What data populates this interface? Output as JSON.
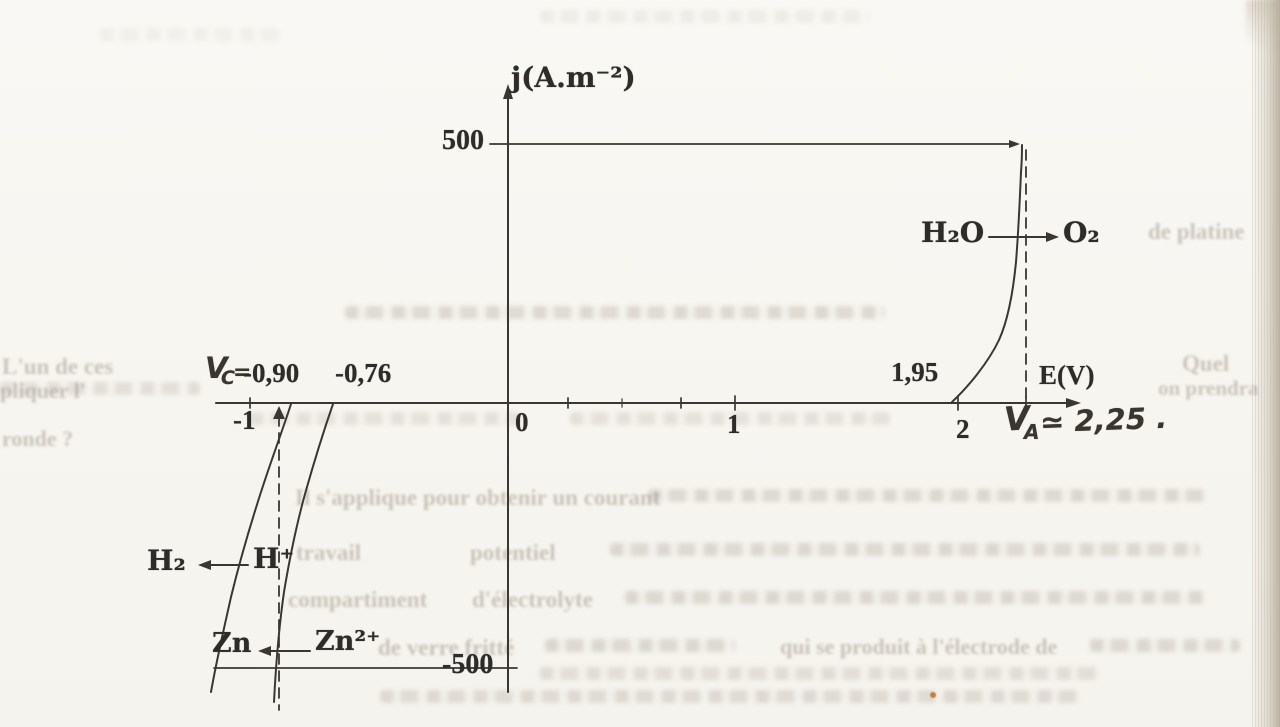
{
  "paper": {
    "background_color": "#f7f5f0",
    "ink_color": "#3a3733",
    "bleed_text_color": "#a49d8d",
    "accent_dot_color": "#c0803d"
  },
  "labels": {
    "y_axis": "j(A.m⁻²)",
    "y_max": "500",
    "y_min": "-500",
    "x_axis": "E(V)",
    "tick_minus1": "-1",
    "tick_0": "0",
    "tick_1": "1",
    "tick_2": "2",
    "anode_onset": "1,95",
    "vc_v": "V",
    "vc_sub": "C",
    "vc_eq": "=",
    "vc_value1": "-0,90",
    "vc_value2": "-0,76",
    "va_v": "V",
    "va_sub": "A",
    "va_value": "≃ 2,25 .",
    "h2o": "H₂O",
    "o2": "O₂",
    "h2": "H₂",
    "hplus": "H⁺",
    "zn": "Zn",
    "zn2plus": "Zn²⁺"
  },
  "bleed": {
    "lun": "L'un de ces",
    "pliquer": "pliquer l'",
    "ronde": "ronde ?",
    "quel": "Quel",
    "prendra": "on prendra",
    "applique": "Il s'applique pour obtenir un courant",
    "travail": "travail",
    "potentiel": "potentiel",
    "compartiment": "compartiment",
    "electrolyte": "d'électrolyte",
    "verre": "de verre fritté",
    "produit": "qui se produit à l'électrode de",
    "platine": "de platine"
  },
  "chart_data": {
    "type": "line",
    "title": "",
    "xlabel": "E(V)",
    "ylabel": "j(A.m⁻²)",
    "xlim": [
      -1.35,
      2.5
    ],
    "ylim": [
      -500,
      500
    ],
    "grid": false,
    "legend_position": "none",
    "x_ticks_labeled": [
      -1,
      0,
      1,
      2
    ],
    "y_ticks_labeled": [
      -500,
      500
    ],
    "series": [
      {
        "name": "H₂O → O₂ (anodic branch)",
        "x": [
          1.95,
          2.05,
          2.15,
          2.21,
          2.25,
          2.28,
          2.3
        ],
        "y": [
          0,
          60,
          180,
          300,
          400,
          460,
          500
        ]
      },
      {
        "name": "Zn²⁺ → Zn (cathodic branch)",
        "x": [
          -0.76,
          -0.8,
          -0.84,
          -0.87,
          -0.89,
          -0.9
        ],
        "y": [
          0,
          -90,
          -210,
          -340,
          -440,
          -500
        ]
      },
      {
        "name": "H⁺ → H₂ (cathodic branch)",
        "x": [
          -0.9,
          -0.98,
          -1.08,
          -1.18,
          -1.26,
          -1.3
        ],
        "y": [
          0,
          -100,
          -230,
          -360,
          -460,
          -500
        ]
      }
    ],
    "dashed_guides": [
      {
        "axis_value": "E = -0.90",
        "from_j": 0,
        "to_j": -500,
        "label": "V_C = -0,90"
      },
      {
        "axis_value": "E ≈ 2.25",
        "from_j": 500,
        "to_j": 0,
        "label": "V_A ≃ 2,25"
      }
    ],
    "reference_lines": [
      {
        "j": 500,
        "label": "500"
      },
      {
        "j": -500,
        "label": "-500"
      }
    ],
    "annotations": [
      {
        "text": "V_C = -0,90  -0,76",
        "position": "above axis, left branch"
      },
      {
        "text": "1,95",
        "position": "above axis at anodic onset"
      },
      {
        "text": "V_A ≃ 2,25 .",
        "position": "below axis at anodic operating point"
      },
      {
        "text": "H₂O → O₂",
        "position": "on anodic curve"
      },
      {
        "text": "H₂ ← H⁺",
        "position": "on left cathodic curve"
      },
      {
        "text": "Zn ← Zn²⁺",
        "position": "on right cathodic curve"
      }
    ]
  }
}
